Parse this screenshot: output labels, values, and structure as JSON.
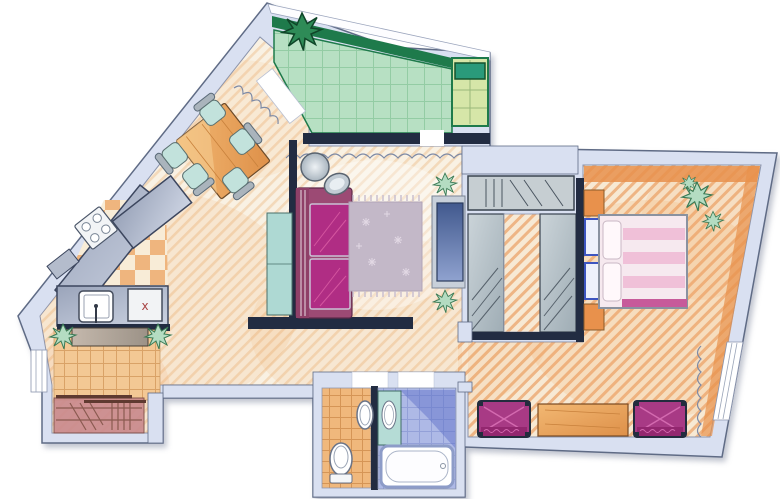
{
  "figure": {
    "type": "floor-plan",
    "style": "hand-drawn watercolor apartment plan",
    "rooms": [
      "balcony",
      "dining-area",
      "kitchen",
      "living-room",
      "hallway",
      "entrance-hall",
      "wc",
      "bathroom",
      "walk-through-wardrobe",
      "bedroom-sitting-room"
    ],
    "furniture": [
      "dining-table",
      "dining-chairs-x5",
      "stove",
      "kitchen-sink",
      "appliance-x",
      "kitchen-island",
      "hall-bench",
      "entrance-closet",
      "sofa",
      "floor-lamp",
      "sideboard",
      "area-rug",
      "tv-unit",
      "wardrobe-panels",
      "double-bed",
      "nightstands-x2",
      "corner-cabinets-x2",
      "desk",
      "armchairs-x2",
      "toilet",
      "wc-sink",
      "vanity-sink",
      "bathtub",
      "plants-x9",
      "curtains"
    ]
  },
  "labels": {
    "appliance_marker": "x"
  },
  "palette": {
    "wall": "#d9e0f1",
    "wallEdge": "#5f6b85",
    "navy": "#222c42",
    "floorBase": "#f9f1e3",
    "floorStripe": "#f3d9ba",
    "floorBaseBed": "#f7e9d4",
    "floorStripeBed": "#eeb585",
    "wash": "#f2a45c",
    "checkerOrange": "#efb57e",
    "checkerCream": "#f8ecd7",
    "tileEntrance": "#f3c894",
    "tileEntranceLine": "#d9a267",
    "balconyGreen": "#b7e0c3",
    "balconyGreenLine": "#93cca4",
    "balconyRail": "#1e7a4b",
    "balconyYellow": "#d6e6a8",
    "balconyTable": "#2a9a7a",
    "wcTile": "#f0b87c",
    "wcTileLine": "#d59556",
    "bathTile": "#aeb9e6",
    "bathTileLine": "#93a0d8",
    "bathShadow": "#5a6cc8",
    "vanityTeal": "#b5dcd6",
    "tubEdge": "#8d9cc8",
    "sofaBody": "#9c4a74",
    "sofaArm": "#8f4068",
    "sofaCushion": "#b02d84",
    "sofaSheen": "#d4559f",
    "sideboardTeal": "#aed9d3",
    "rug": "#c3b8c8",
    "rugFringe": "#c9bfcf",
    "tvPanel": "#c8d0da",
    "bedBase": "#f6e9ef",
    "bedStripe": "#efb9d4",
    "bedFoot": "#c75a9a",
    "nightstandBlue": "#3d55c0",
    "cabinetOrange": "#e8914c",
    "armchairMagenta": "#a83a85",
    "armchairLine": "#d46ab0",
    "closetRose": "#c9898c",
    "closetLine": "#8a5a50",
    "benchA": "#c4b8ac",
    "benchB": "#9c9287",
    "chairSeat": "#c2e2dc",
    "chairBack": "#aab4bc",
    "plantGreen": "#b4dcc2",
    "plantEdge": "#3a7a55",
    "plantDark": "#2e8b57",
    "curtain": "#7d8aa6",
    "xMark": "#a84444",
    "white": "#ffffff"
  }
}
